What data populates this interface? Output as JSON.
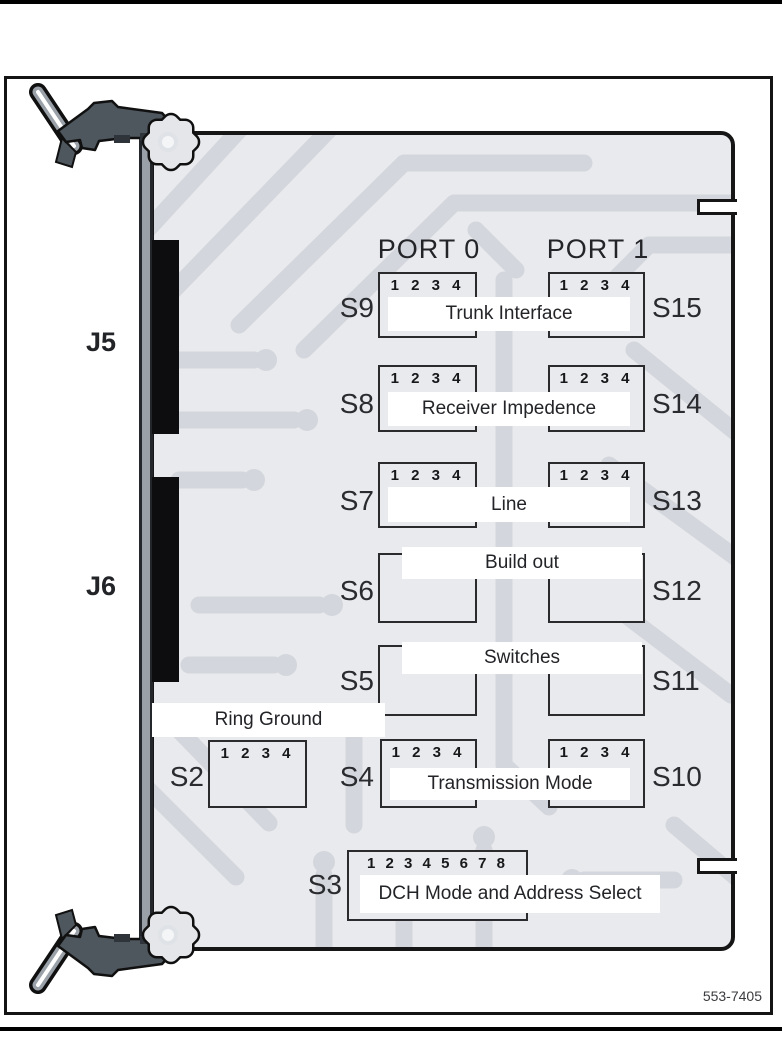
{
  "page": {
    "figure_number": "553-7405"
  },
  "ports": {
    "port0": "PORT 0",
    "port1": "PORT 1"
  },
  "connectors": {
    "j5": "J5",
    "j6": "J6"
  },
  "switch_rows": [
    {
      "left": "S9",
      "right": "S15",
      "label": "Trunk Interface",
      "numbers": "1 2 3 4"
    },
    {
      "left": "S8",
      "right": "S14",
      "label": "Receiver Impedence",
      "numbers": "1 2 3 4"
    },
    {
      "left": "S7",
      "right": "S13",
      "label": "Line",
      "numbers": "1 2 3 4"
    },
    {
      "left": "S6",
      "right": "S12",
      "label": "Build out"
    },
    {
      "left": "S5",
      "right": "S11",
      "label": "Switches"
    }
  ],
  "ring_ground": {
    "label": "Ring Ground",
    "switch": "S2",
    "numbers": "1 2 3 4"
  },
  "transmission_row": {
    "left": "S4",
    "right": "S10",
    "label": "Transmission Mode",
    "numbers": "1 2 3 4"
  },
  "dch_row": {
    "switch": "S3",
    "label": "DCH Mode and Address Select",
    "numbers": "1 2 3 4 5 6 7 8"
  },
  "colors": {
    "board_background": "#e9eaed",
    "trace": "#d3d6dc",
    "outline": "#161616",
    "connector_black": "#0d0d0f",
    "hardware_gray": "#4e565e",
    "band_white": "#ffffff"
  }
}
